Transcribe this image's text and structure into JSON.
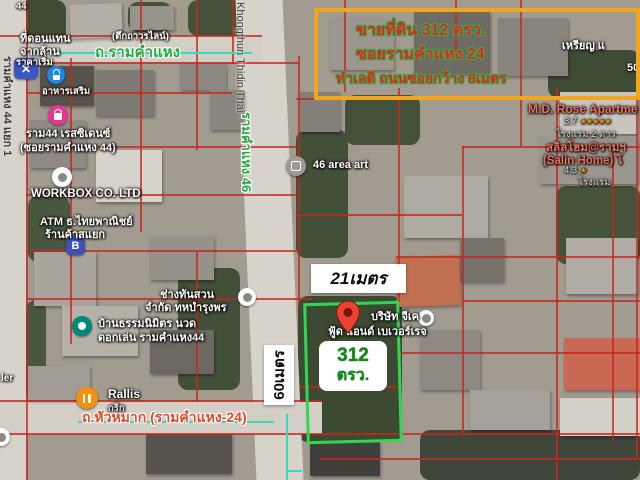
{
  "colors": {
    "accent-orange": "#f2a51f",
    "sale-red": "#e8231b",
    "sale-halo": "#2bb14d",
    "road-green": "#27a844",
    "plot-green": "#33d653",
    "teal": "#38d8b8",
    "bottom-road": "#e2492a",
    "pin-red": "#ea4335",
    "lodging": "#ef6f60",
    "area-green": "#0f8a16",
    "parcel-red": "#c5281c"
  },
  "sale_box": {
    "line1": "ขายที่ดิน 312 ตรว.",
    "line2": "ซอยรามคำแหง 24",
    "line3": "ทำเลดี ถนนซอยกว้าง 8เมตร"
  },
  "measurements": {
    "width": "21เมตร",
    "depth": "60เมตร",
    "area_value": "312",
    "area_unit": "ตรว."
  },
  "roads": {
    "top": "ถ.รามคำแหง",
    "center_en": "Khongthun Thidin Thai",
    "center_th": "รามคำแหง 46",
    "left": "รามคำแหง 44 แยก 1",
    "bottom": "ถ.หัวหมาก (รามคำแหง-24)"
  },
  "pois": {
    "don": {
      "line1": "ที่ดอนแทน",
      "line2": "จากล้าน",
      "line3": "ราคาเริ่ม",
      "caption": "อาหารเสริม",
      "extra": "(ตึกถาวรไลน์)"
    },
    "ram44": {
      "line1": "ราม44 เรสซิเดนซ์",
      "line2": "(ซอยรามคำแหง 44)"
    },
    "workbox": {
      "line1": "WORKBOX CO. LTD"
    },
    "atm": {
      "line1": "ATM ธ.ไทยพาณิชย์",
      "line2": "ร้านค้าสแยก"
    },
    "garden": {
      "line1": "ช่างทันสวน",
      "line2": "จำกัด ทหบำรุงพร"
    },
    "baan": {
      "line1": "บ้านธรรมนิมิตร นวด",
      "line2": "ดอกเล่น รามคำแหง44"
    },
    "areaart": {
      "line1": "46 area art"
    },
    "gk": {
      "line1": "บริษัท จีเค",
      "line2": "ฟู้ด แอนด์ เบเวอร์เรจ"
    },
    "rallis": {
      "line1": "Rallis",
      "line2": "กรีก"
    }
  },
  "listings": {
    "rose": {
      "name": "M.D. Rose Apartme",
      "rating": "3.7",
      "stars": "★★★★★",
      "type": "โรงแรม 2 ดาว"
    },
    "salin": {
      "name": "สลิลโฮม@รามฯ",
      "name2": "(Salin Home) โ",
      "rating": "4.3",
      "stars": "★",
      "type": "โรงแรม"
    }
  },
  "fragments": {
    "top_left": "44",
    "coin": "เหรียญ แ",
    "fifty": "50",
    "ler": "ler"
  }
}
